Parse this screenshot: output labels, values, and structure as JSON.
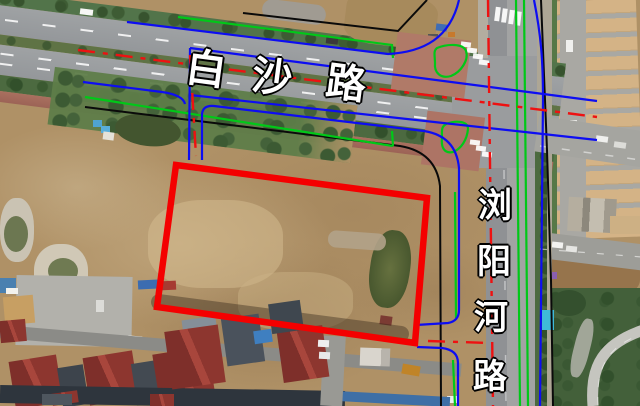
{
  "map_labels": {
    "baisha_road": {
      "text": "白沙路",
      "chars": [
        "白",
        "沙",
        "路"
      ],
      "orientation": "horizontal-along-road"
    },
    "liuyanghe_road": {
      "text": "浏阳河路",
      "chars": [
        "浏",
        "阳",
        "河",
        "路"
      ],
      "orientation": "vertical-along-road"
    }
  },
  "overlay": {
    "parcel_outline_color": "#f40000",
    "road_edge_line_color": "#0d0df2",
    "green_line_color": "#00c818",
    "centerline_color": "#ee1111",
    "boundary_line_color": "#0a0a0a",
    "crosswalk_color": "#ffffff"
  }
}
